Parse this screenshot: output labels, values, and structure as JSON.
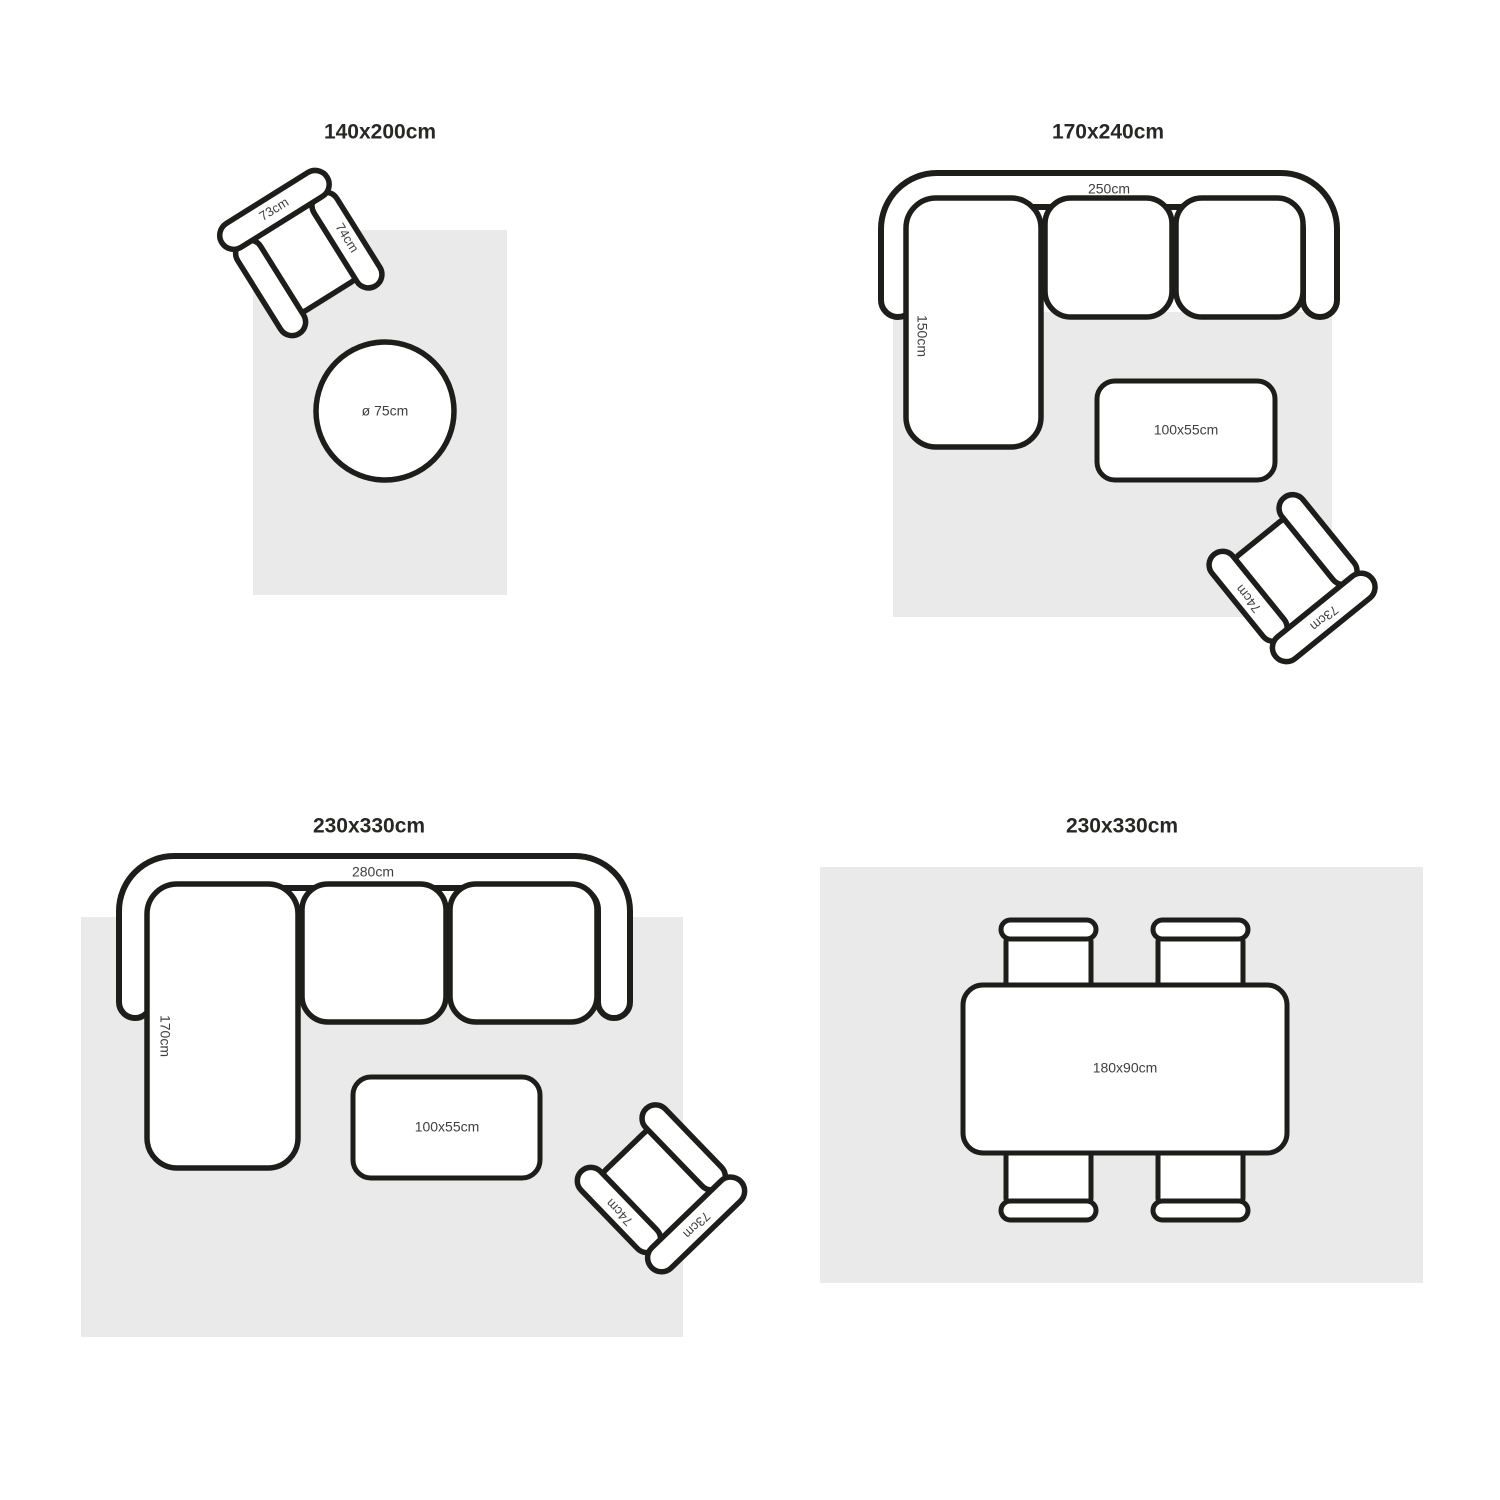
{
  "colors": {
    "stroke": "#1d1d1b",
    "rug": "#eaeaea",
    "label": "#3f3f3e",
    "title": "#272725"
  },
  "quadrants": [
    {
      "title": "140x200cm",
      "armchair": {
        "back_label": "73cm",
        "arm_label": "74cm"
      },
      "round_table_label": "ø 75cm"
    },
    {
      "title": "170x240cm",
      "sofa": {
        "width_label": "250cm",
        "depth_label": "150cm"
      },
      "coffee_table_label": "100x55cm",
      "armchair": {
        "back_label": "73cm",
        "arm_label": "74cm"
      }
    },
    {
      "title": "230x330cm",
      "sofa": {
        "width_label": "280cm",
        "depth_label": "170cm"
      },
      "coffee_table_label": "100x55cm",
      "armchair": {
        "back_label": "73cm",
        "arm_label": "74cm"
      }
    },
    {
      "title": "230x330cm",
      "dining_table_label": "180x90cm"
    }
  ]
}
